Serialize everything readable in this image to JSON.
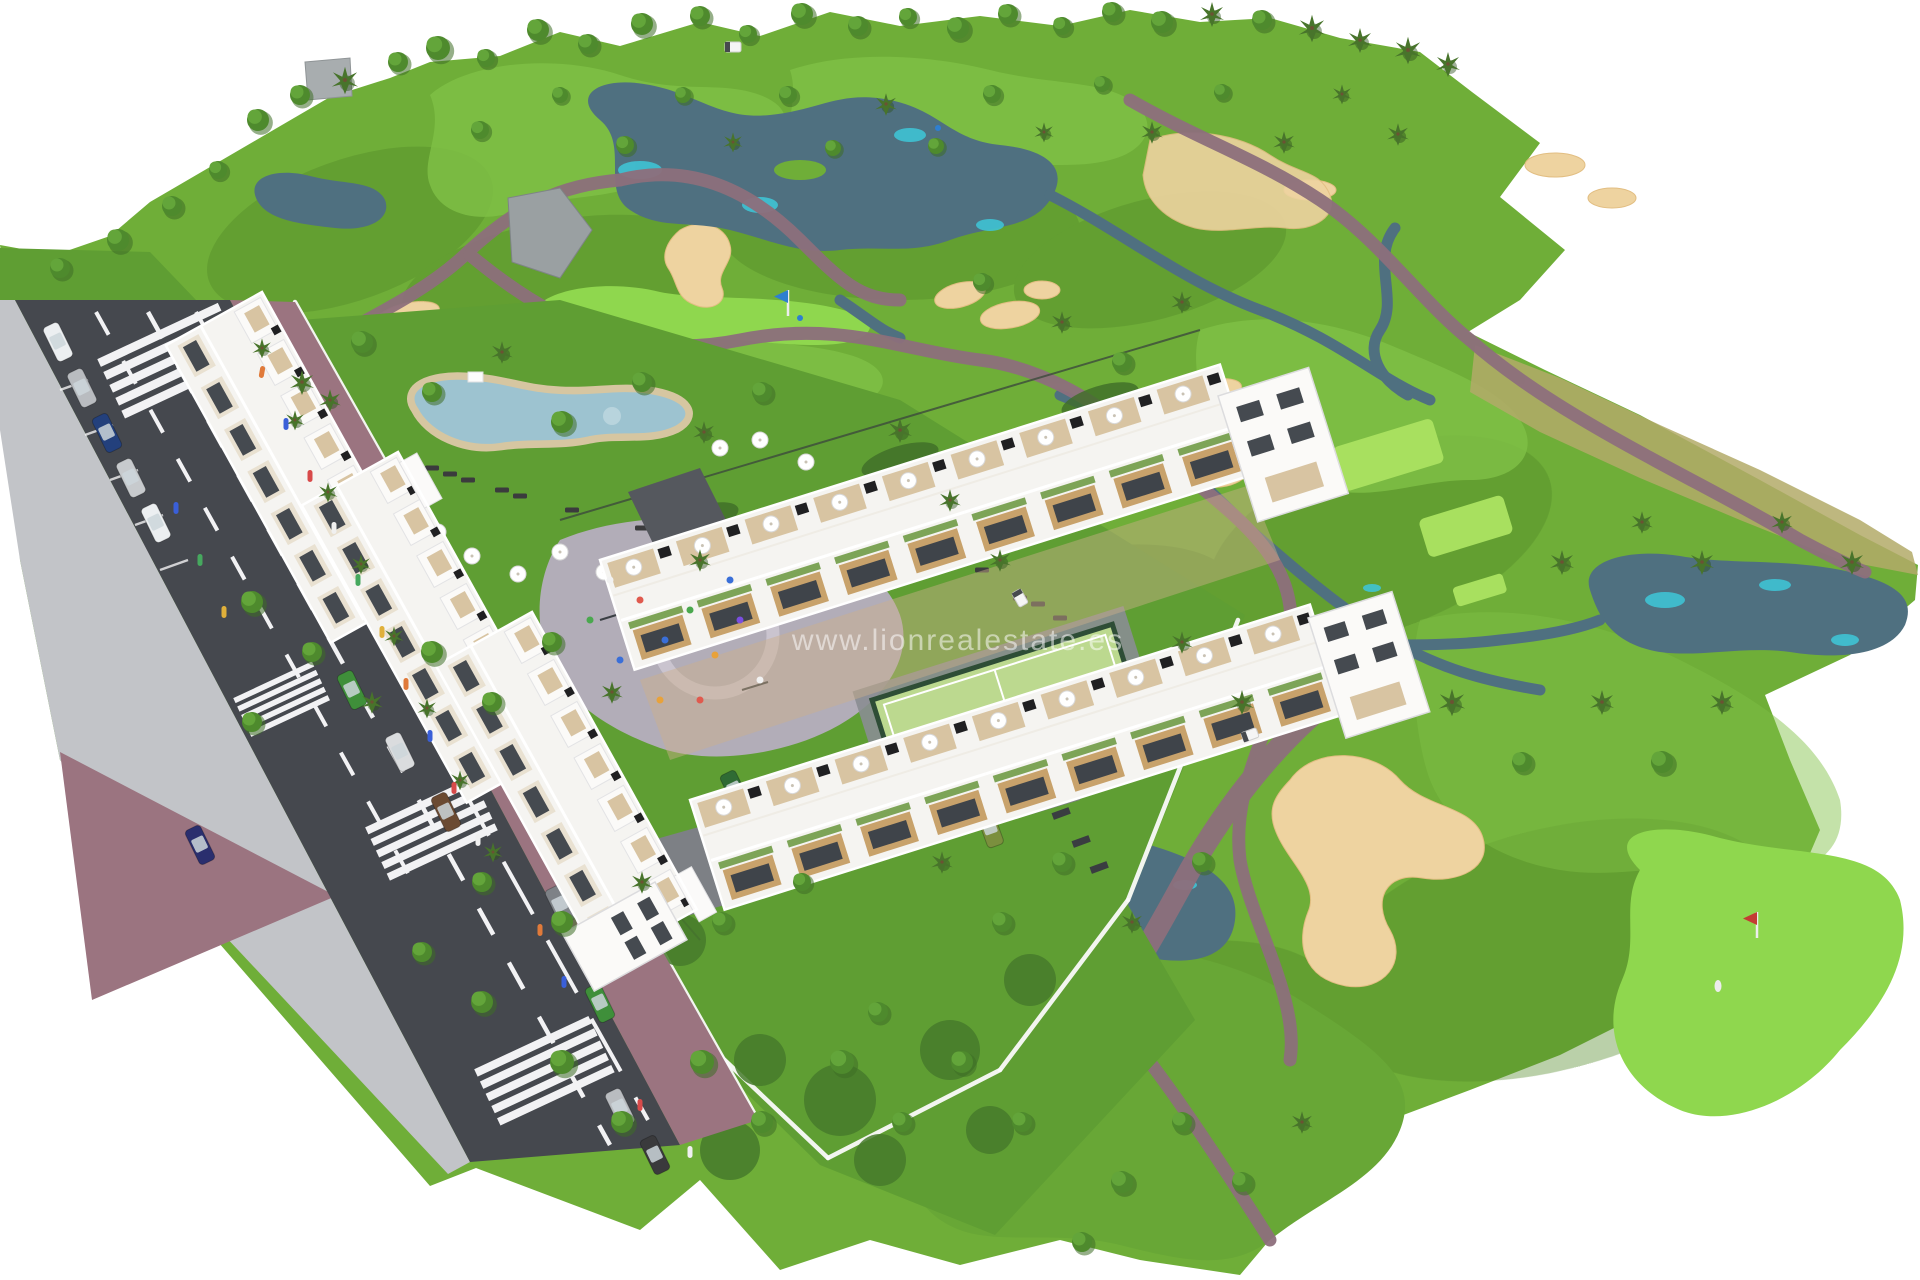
{
  "watermark": {
    "text": "www.lionrealestate.es",
    "color": "rgba(255,255,255,0.52)"
  },
  "palette": {
    "background": "#ffffff",
    "grass_base": "#6fae38",
    "grass_dark": "#53892a",
    "fairway_light": "#7fc046",
    "green_bright": "#8fd74e",
    "tee_light": "#a8e05f",
    "water_dark": "#4f7080",
    "water_teal": "#3fc3d4",
    "sand": "#eed3a0",
    "scrub_sand": "#b3aa68",
    "path": "#8d6f7c",
    "road": "#45484e",
    "sidewalk_brick": "#9b7480",
    "sidewalk_gray": "#c2c4c8",
    "building_white": "#f5f4f1",
    "wood_accent": "#c8a26b",
    "deck_tan": "#d8c4a2",
    "pool_water": "#9dc3d0",
    "court_turf": "#bcd98f",
    "lawn": "#5f9e33"
  }
}
